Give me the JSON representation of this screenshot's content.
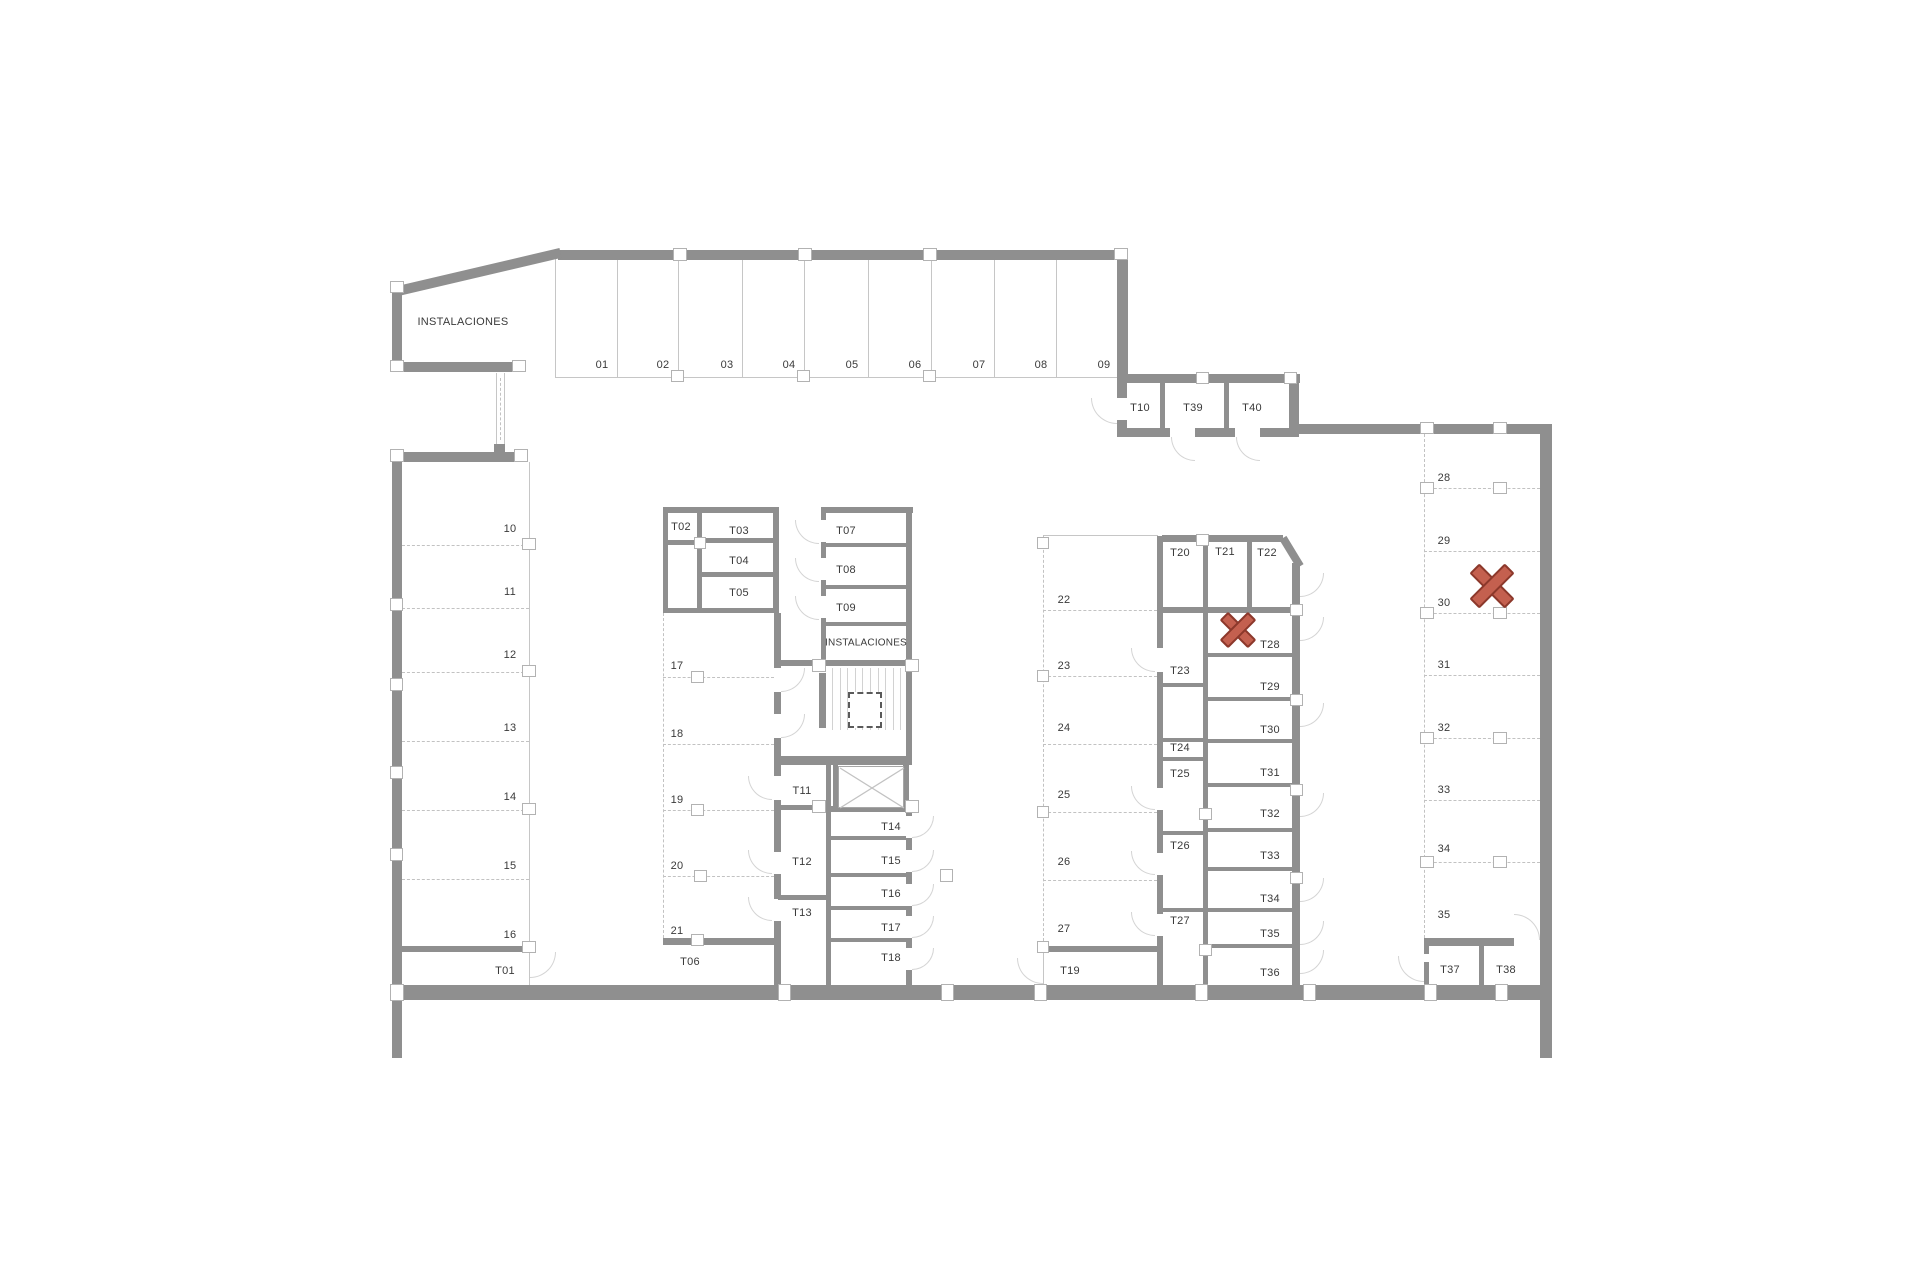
{
  "floor_plan": {
    "type": "parking-storage-level",
    "background_color": "#ffffff",
    "wall_color": "#8f8f8f",
    "thin_line_color": "#c6c6c6",
    "label_color": "#3a3a3a",
    "areas": {
      "instalaciones_upper": "INSTALACIONES",
      "instalaciones_core": "INSTALACIONES"
    },
    "parking_spots": {
      "s01": "01",
      "s02": "02",
      "s03": "03",
      "s04": "04",
      "s05": "05",
      "s06": "06",
      "s07": "07",
      "s08": "08",
      "s09": "09",
      "s10": "10",
      "s11": "11",
      "s12": "12",
      "s13": "13",
      "s14": "14",
      "s15": "15",
      "s16": "16",
      "s17": "17",
      "s18": "18",
      "s19": "19",
      "s20": "20",
      "s21": "21",
      "s22": "22",
      "s23": "23",
      "s24": "24",
      "s25": "25",
      "s26": "26",
      "s27": "27",
      "s28": "28",
      "s29": "29",
      "s30": "30",
      "s31": "31",
      "s32": "32",
      "s33": "33",
      "s34": "34",
      "s35": "35"
    },
    "storage_rooms": {
      "t01": "T01",
      "t02": "T02",
      "t03": "T03",
      "t04": "T04",
      "t05": "T05",
      "t06": "T06",
      "t07": "T07",
      "t08": "T08",
      "t09": "T09",
      "t10": "T10",
      "t11": "T11",
      "t12": "T12",
      "t13": "T13",
      "t14": "T14",
      "t15": "T15",
      "t16": "T16",
      "t17": "T17",
      "t18": "T18",
      "t19": "T19",
      "t20": "T20",
      "t21": "T21",
      "t22": "T22",
      "t23": "T23",
      "t24": "T24",
      "t25": "T25",
      "t26": "T26",
      "t27": "T27",
      "t28": "T28",
      "t29": "T29",
      "t30": "T30",
      "t31": "T31",
      "t32": "T32",
      "t33": "T33",
      "t34": "T34",
      "t35": "T35",
      "t36": "T36",
      "t37": "T37",
      "t38": "T38",
      "t39": "T39",
      "t40": "T40"
    },
    "markers": [
      {
        "id": "x-marker-storage-t28",
        "symbol": "X",
        "location": "storage room T28",
        "fill": "#c4604f",
        "border": "#8c382b"
      },
      {
        "id": "x-marker-parking-30",
        "symbol": "X",
        "location": "parking spot 30",
        "fill": "#c4604f",
        "border": "#8c382b"
      }
    ]
  }
}
